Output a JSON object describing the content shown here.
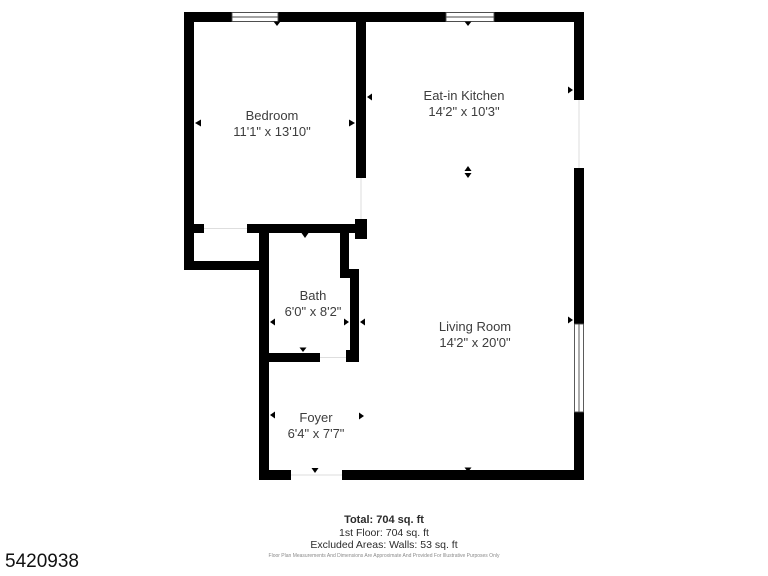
{
  "plan": {
    "rooms": [
      {
        "name": "Bedroom",
        "dimensions": "11'1\" x 13'10\""
      },
      {
        "name": "Eat-in Kitchen",
        "dimensions": "14'2\" x 10'3\""
      },
      {
        "name": "Bath",
        "dimensions": "6'0\" x 8'2\""
      },
      {
        "name": "Living Room",
        "dimensions": "14'2\" x 20'0\""
      },
      {
        "name": "Foyer",
        "dimensions": "6'4\" x 7'7\""
      }
    ]
  },
  "summary": {
    "total": "Total: 704 sq. ft",
    "first_floor": "1st Floor: 704 sq. ft",
    "excluded": "Excluded Areas: Walls: 53 sq. ft"
  },
  "disclaimer": "Floor Plan Measurements And Dimensions Are Approximate And Provided For Illustrative Purposes Only",
  "listing_id": "5420938",
  "colors": {
    "wall": "#000000",
    "label_text": "#3d3d3d",
    "footer_text": "#2b2b2b",
    "disclaimer_text": "#8a8a8a",
    "background": "#ffffff"
  }
}
